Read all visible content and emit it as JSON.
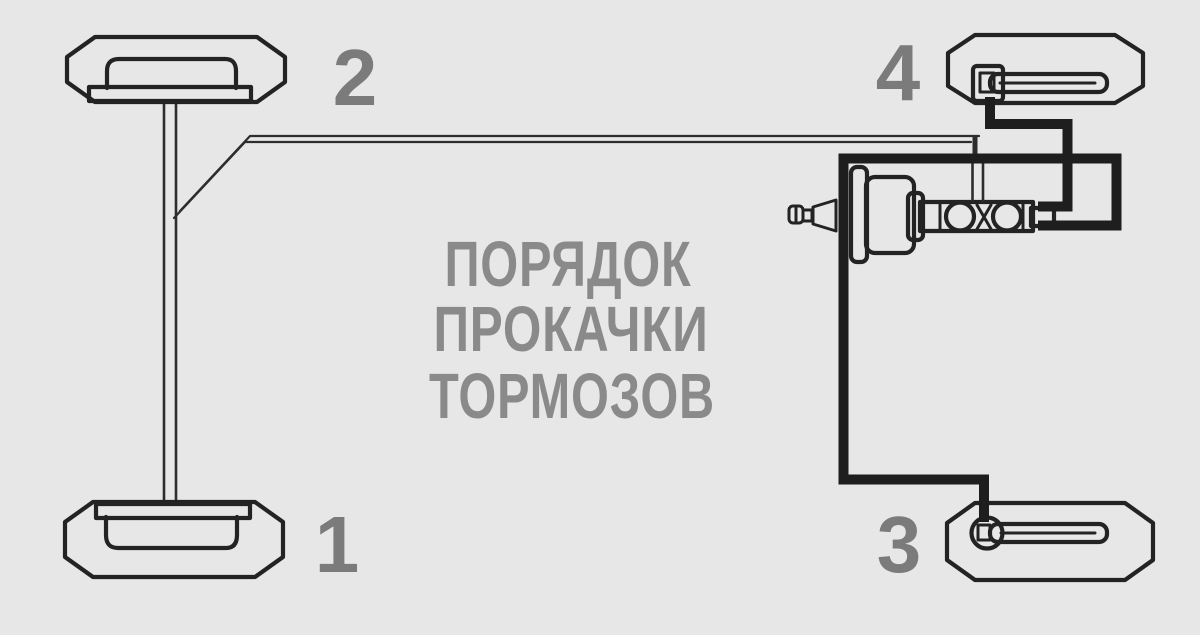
{
  "diagram": {
    "title": {
      "line1": "ПОРЯДОК",
      "line2": "ПРОКАЧКИ",
      "line3": "ТОРМОЗОВ"
    },
    "bleed_order": {
      "rear_left": "1",
      "front_left": "2",
      "rear_right": "3",
      "front_right": "4"
    },
    "colors": {
      "background": "#e7e7e7",
      "line": "#232323",
      "thick_line": "#1e1e1e",
      "label_gray": "#7b7b7b",
      "title_gray": "#8a8a8a"
    }
  }
}
